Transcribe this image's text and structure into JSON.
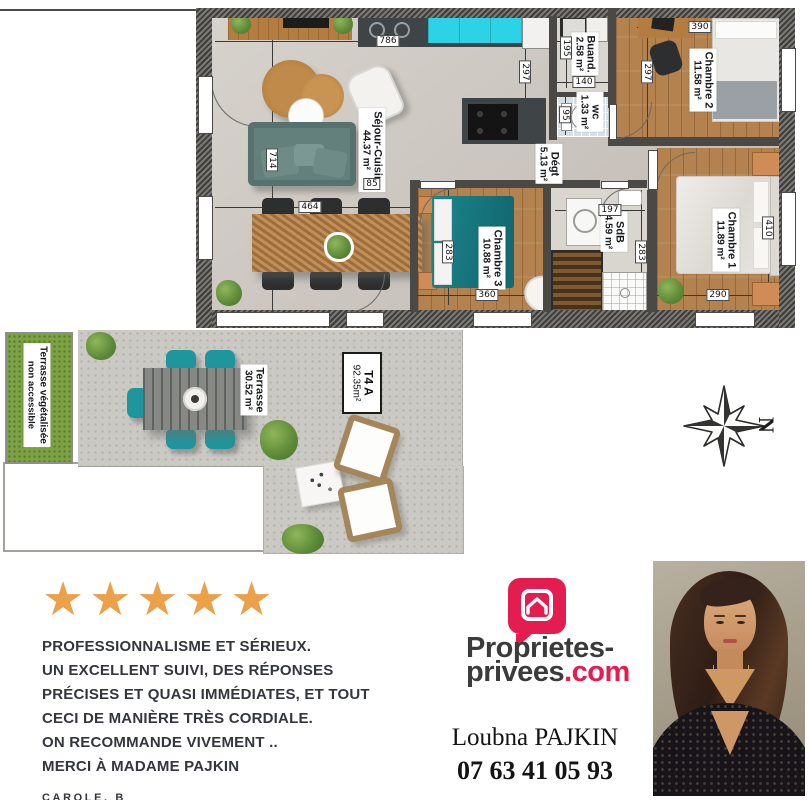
{
  "plan": {
    "rooms": [
      {
        "name": "Séjour-Cuisine",
        "area": "44.37 m²"
      },
      {
        "name": "Buand.",
        "area": "2.58 m²"
      },
      {
        "name": "wc",
        "area": "1.33 m²"
      },
      {
        "name": "Dégt",
        "area": "5.13 m²"
      },
      {
        "name": "Chambre 2",
        "area": "11.58 m²"
      },
      {
        "name": "Chambre 1",
        "area": "11.89 m²"
      },
      {
        "name": "Chambre 3",
        "area": "10.88 m²"
      },
      {
        "name": "SdB",
        "area": "4.59 m²"
      },
      {
        "name": "Terrasse",
        "area": "30.52 m²"
      },
      {
        "name": "Terrasse végétalisée",
        "area": "non accessible"
      },
      {
        "name": "T4 A",
        "area": "92.35m²"
      }
    ],
    "dims": [
      "786",
      "714",
      "464",
      "297",
      "195",
      "140",
      "95",
      "85",
      "390",
      "297",
      "197",
      "283",
      "283",
      "360",
      "290",
      "410"
    ],
    "compass": {
      "north_letter": "N"
    }
  },
  "review": {
    "stars": "★★★★★",
    "lines": [
      "PROFESSIONNALISME ET SÉRIEUX.",
      "UN EXCELLENT SUIVI, DES RÉPONSES",
      "PRÉCISES ET QUASI IMMÉDIATES, ET TOUT",
      "CECI DE MANIÈRE TRÈS CORDIALE.",
      "ON RECOMMANDE VIVEMENT ..",
      "MERCI À MADAME PAJKIN"
    ],
    "author": "CAROLE. B"
  },
  "agency": {
    "logo_line1": "Proprietes-",
    "logo_name": "privees",
    "logo_tld": ".com",
    "agent_name": "Loubna PAJKIN",
    "agent_phone": "07 63 41 05 93"
  },
  "colors": {
    "accent_pink": "#e41d50",
    "star_orange": "#eba04a",
    "kitchen_cyan": "#2cd3e6",
    "chair_teal": "#1f969e"
  }
}
